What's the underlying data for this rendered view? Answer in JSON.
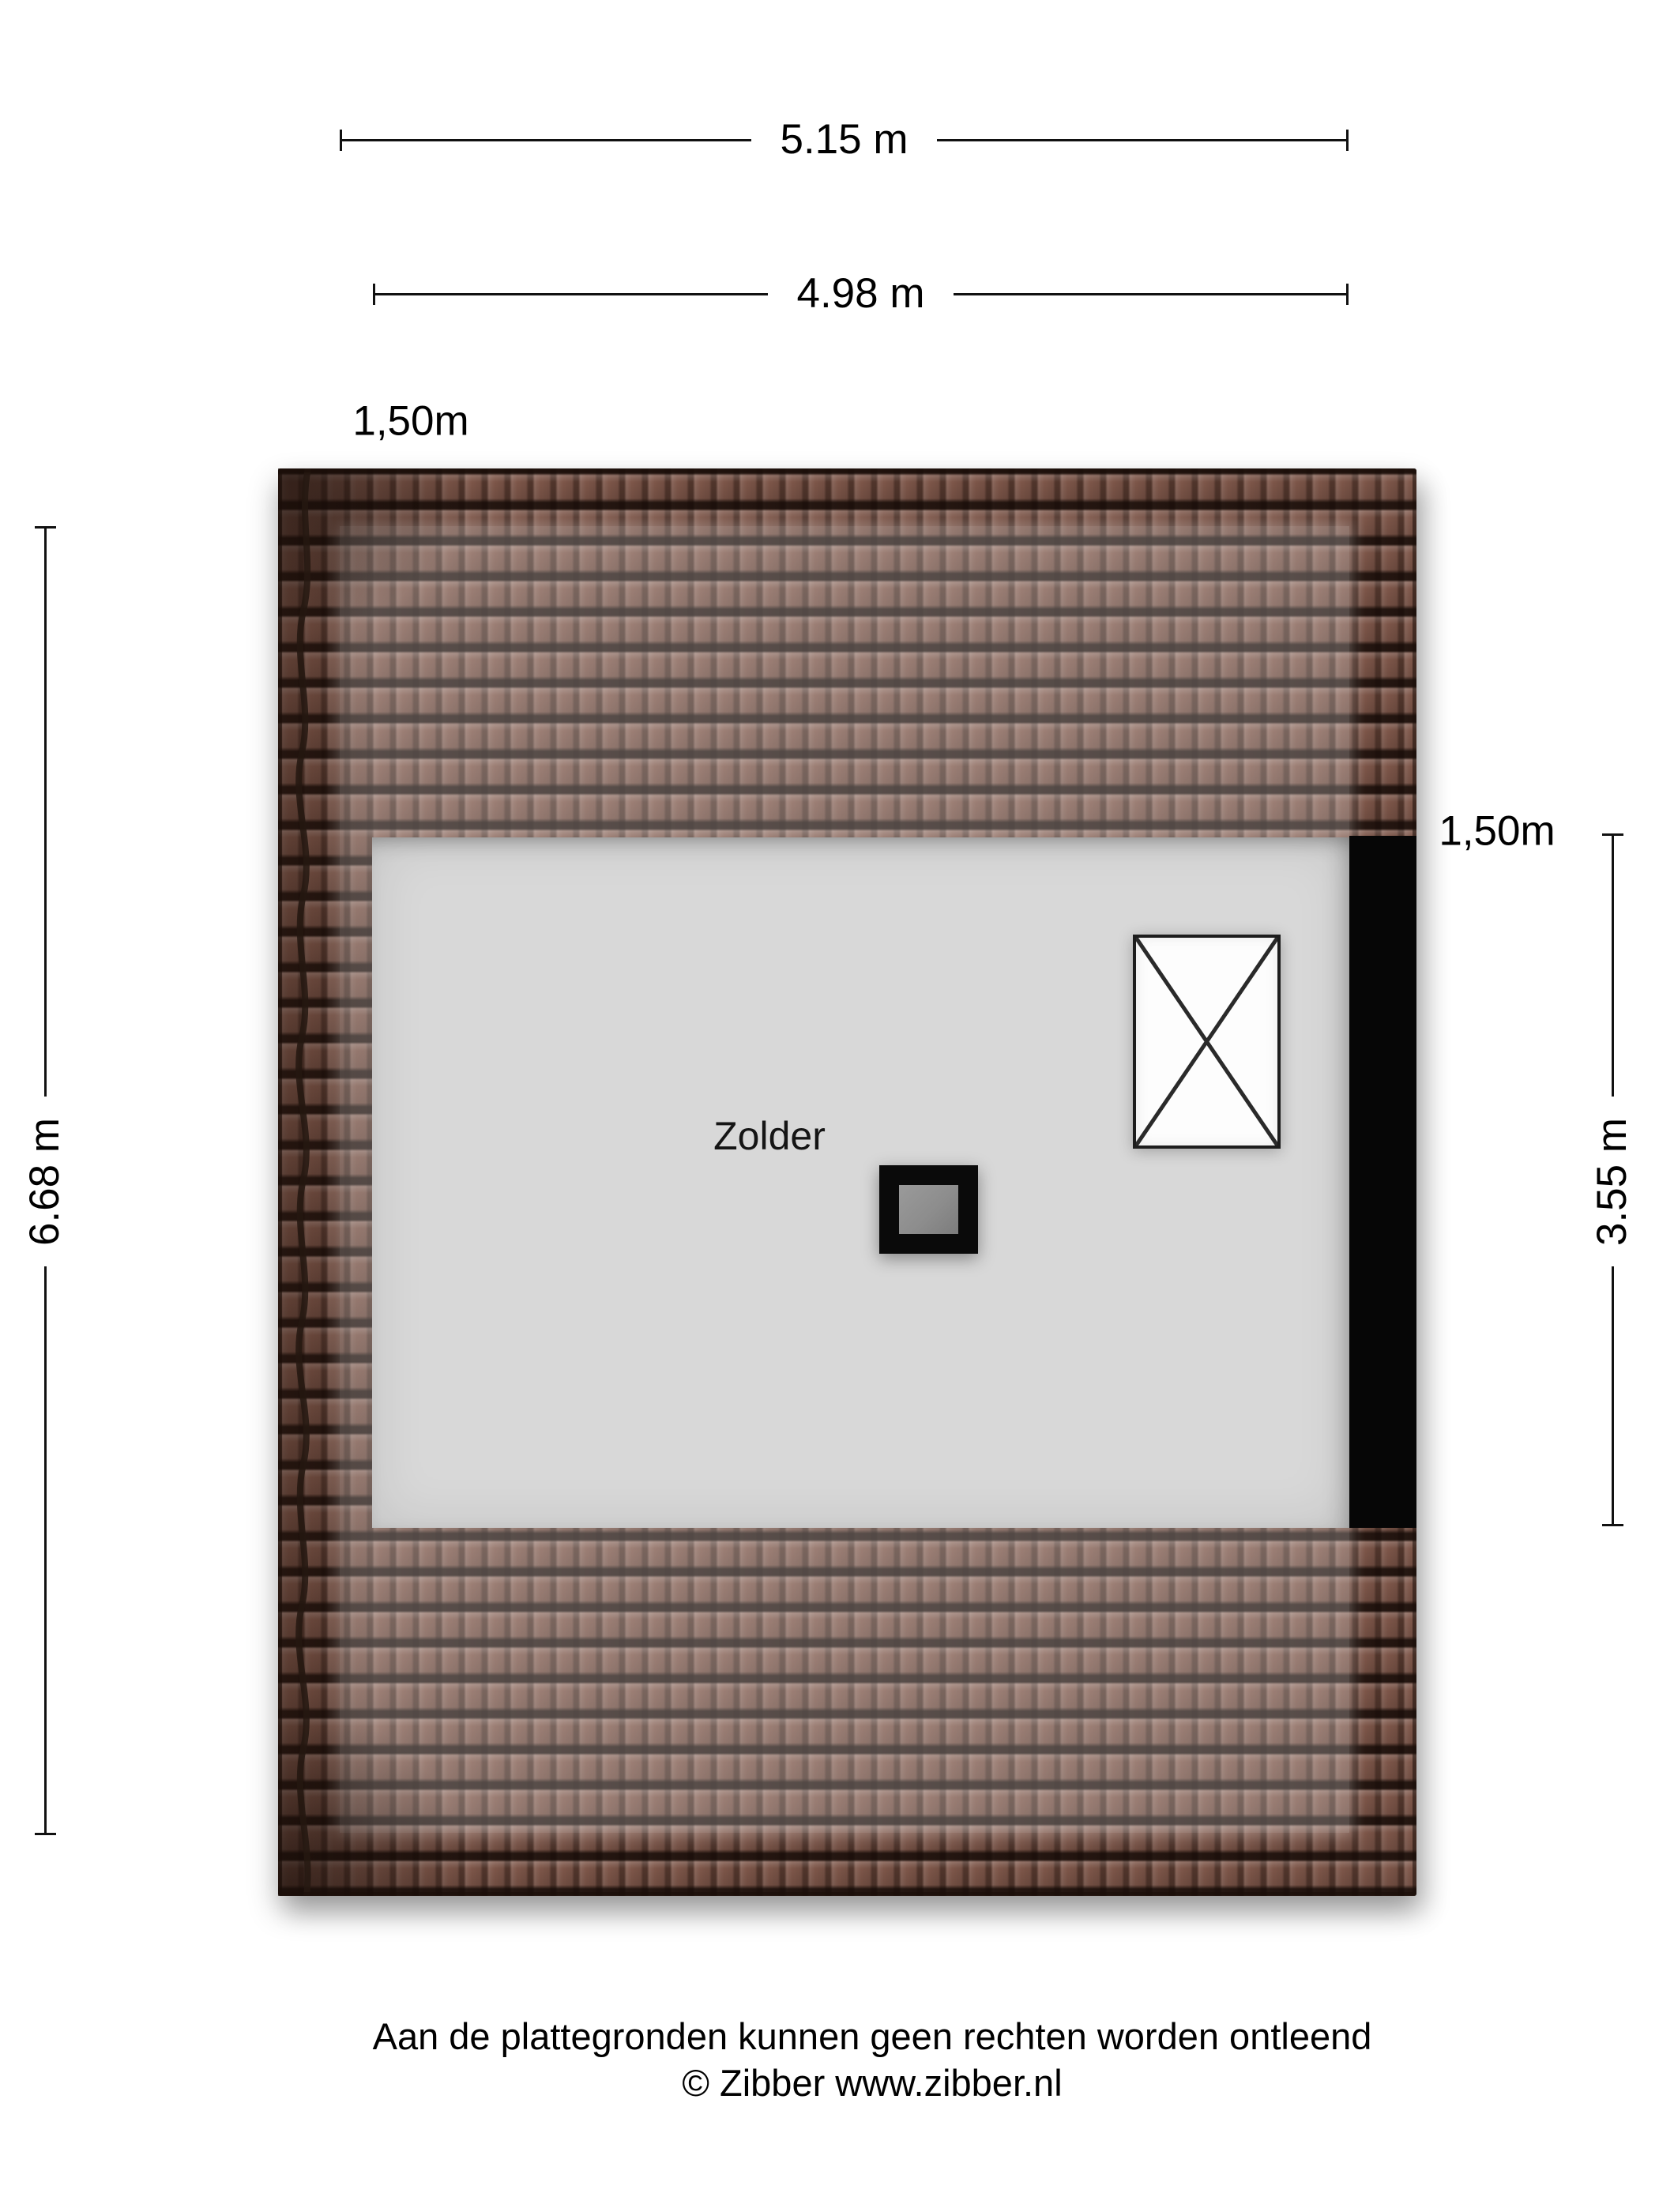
{
  "dimensions": {
    "width_total": {
      "label": "5.15 m"
    },
    "width_inner": {
      "label": "4.98 m"
    },
    "height_total": {
      "label": "6.68 m"
    },
    "height_inner": {
      "label": "3.55 m"
    },
    "knee_wall_left": {
      "label": "1,50m"
    },
    "knee_wall_right": {
      "label": "1,50m"
    }
  },
  "room": {
    "name": "Zolder"
  },
  "footer": {
    "disclaimer": "Aan de plattegronden kunnen geen rechten worden ontleend",
    "copyright": "© Zibber www.zibber.nl"
  },
  "colors": {
    "ink": "#111111",
    "tile-base": "#7d5649",
    "floor": "#d8d8d8",
    "strip": "#060606",
    "wash": "rgba(255,255,255,0.24)",
    "chimney-inner": "#8d8d8d"
  }
}
